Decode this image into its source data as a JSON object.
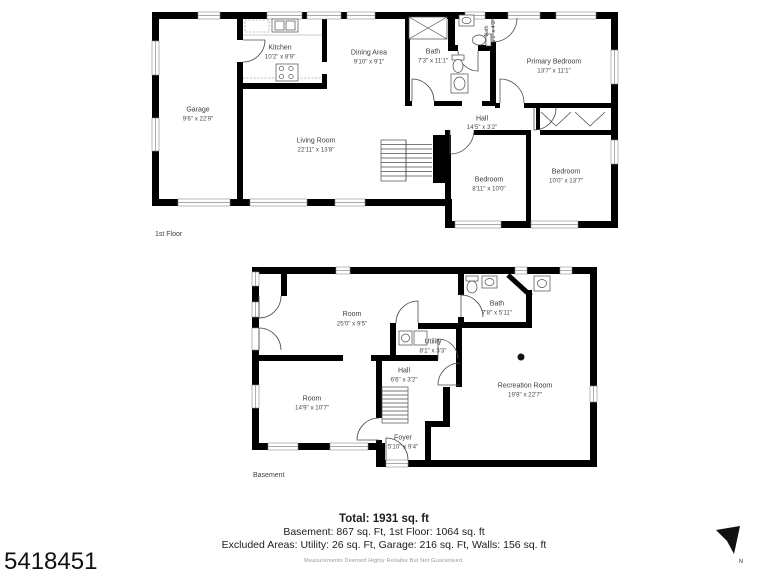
{
  "floors": {
    "first": {
      "label": "1st Floor",
      "rooms": {
        "kitchen": {
          "name": "Kitchen",
          "dims": "10'2\" x 8'9\""
        },
        "dining": {
          "name": "Dining Area",
          "dims": "9'10\" x 9'1\""
        },
        "garage": {
          "name": "Garage",
          "dims": "9'6\" x 22'9\""
        },
        "living": {
          "name": "Living Room",
          "dims": "22'11\" x 13'8\""
        },
        "bath": {
          "name": "Bath",
          "dims": "7'3\" x 11'1\""
        },
        "bath_small": {
          "name": "Bath",
          "dims": "5'1\" x 4'3\""
        },
        "primary": {
          "name": "Primary Bedroom",
          "dims": "13'7\" x 11'1\""
        },
        "hall": {
          "name": "Hall",
          "dims": "14'5\" x 3'2\""
        },
        "bedroom1": {
          "name": "Bedroom",
          "dims": "8'11\" x 10'0\""
        },
        "bedroom2": {
          "name": "Bedroom",
          "dims": "10'0\" x 13'7\""
        }
      }
    },
    "basement": {
      "label": "Basement",
      "rooms": {
        "room1": {
          "name": "Room",
          "dims": "25'0\" x 9'5\""
        },
        "bath": {
          "name": "Bath",
          "dims": "7'8\" x 5'11\""
        },
        "utility": {
          "name": "Utility",
          "dims": "8'1\" x 3'3\""
        },
        "hall": {
          "name": "Hall",
          "dims": "6'6\" x 3'2\""
        },
        "room2": {
          "name": "Room",
          "dims": "14'9\" x 10'7\""
        },
        "foyer": {
          "name": "Foyer",
          "dims": "5'10\" x 9'4\""
        },
        "rec": {
          "name": "Recreation Room",
          "dims": "19'8\" x 22'7\""
        }
      }
    }
  },
  "summary": {
    "total": "Total: 1931 sq. ft",
    "line2": "Basement: 867 sq. Ft, 1st Floor: 1064 sq. ft",
    "line3": "Excluded Areas: Utility: 26 sq. Ft, Garage: 216 sq. Ft, Walls: 156 sq. ft",
    "disclaimer": "Measurements Deemed Highly Reliable But Not Guaranteed."
  },
  "listing_id": "5418451",
  "compass": {
    "label": "N"
  },
  "colors": {
    "walls": "#000000",
    "room_labels": "#3d3d3d",
    "footer_text": "#1d1d1d",
    "disclaimer": "#9a9a9a"
  }
}
